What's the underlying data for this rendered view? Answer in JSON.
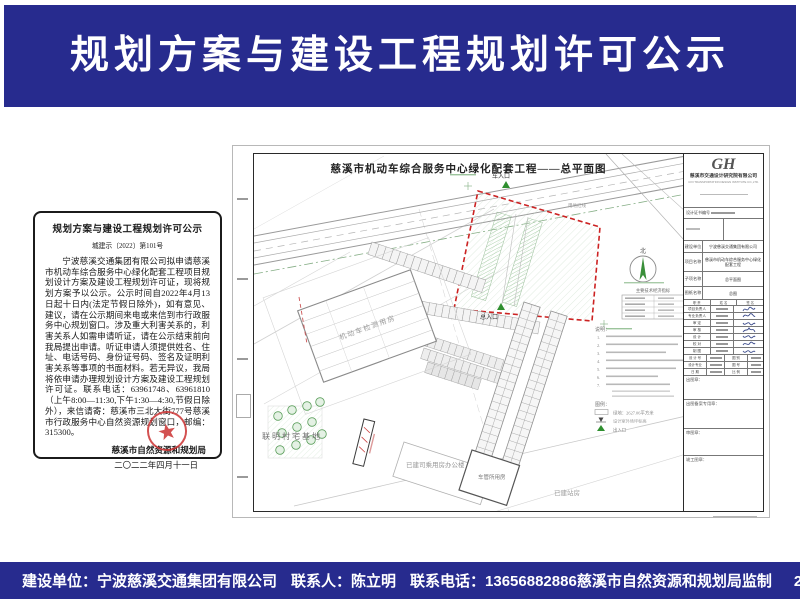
{
  "banner": {
    "title": "规划方案与建设工程规划许可公示"
  },
  "notice": {
    "title": "规划方案与建设工程规划许可公示",
    "doc_no": "城建示〔2022〕第101号",
    "body": "宁波慈溪交通集团有限公司拟申请慈溪市机动车综合服务中心绿化配套工程项目规划设计方案及建设工程规划许可证，现将规划方案予以公示。公示时间自2022年4月13日起十日内(法定节假日除外)，如有意见、建议，请在公示期间来电或来信到市行政服务中心规划窗口。涉及重大利害关系的，利害关系人如需申请听证，请在公示结束前向我局提出申请。听证申请人须提供姓名、住址、电话号码、身份证号码、签名及证明利害关系等事项的书面材料。若无异议，我局将依申请办理规划设计方案及建设工程规划许可证。联系电话：63961748、63961810（上午8:00—11:30,下午1:30—4:30,节假日除外），来信请寄：慈溪市三北大街777号慈溪市行政服务中心自然资源规划窗口，邮编：315300。",
    "agency": "慈溪市自然资源和规划局",
    "date": "二〇二二年四月十一日"
  },
  "drawing": {
    "title": "慈溪市机动车综合服务中心绿化配套工程——总平面图",
    "labels": {
      "vehicle_entrance": "车入口",
      "main_entrance": "总入口",
      "red_line": "用地红线",
      "north": "北",
      "inspection_building": "机动车检测用房",
      "village": "联明村宅基地",
      "office": "已建司乘用房办公楼",
      "vehicle_admin": "车管所用房",
      "station": "已建站房"
    },
    "indicator_table_title": "主要技术经济指标",
    "notes_label": "说明：",
    "note_numbers": [
      "1.",
      "2.",
      "3.",
      "4.",
      "5.",
      "6.",
      "7."
    ],
    "legend_label": "图例：",
    "legend": {
      "green_area": "绿地：2627.06平方米",
      "level_mark": "设计室外场坪标高",
      "entrance": "出入口"
    }
  },
  "titleblock": {
    "logo": "GH",
    "company": "慈溪市交通设计研究院有限公司",
    "company_en": "CIXI TRANSPORTATION DESIGN INSTITUTE CO.,LTD.",
    "cert_label": "设计证书编号",
    "info_rows": [
      {
        "label": "建设单位",
        "value": "宁波慈溪交通集团有限公司"
      },
      {
        "label": "项目名称",
        "value": "慈溪市机动车综合服务中心绿化配套工程"
      },
      {
        "label": "子项名称",
        "value": "总平面图"
      },
      {
        "label": "图纸名称",
        "value": "总图"
      }
    ],
    "sig_header": [
      "职 责",
      "姓 名",
      "签 名"
    ],
    "sig_roles": [
      "项目负责人",
      "专业负责人",
      "审 定",
      "审 核",
      "设 计",
      "校 对",
      "制 图"
    ],
    "meta_rows": [
      [
        "设 计 号",
        "图 别"
      ],
      [
        "设计专业",
        "图 号"
      ],
      [
        "日 期",
        "比 例"
      ]
    ],
    "stamps": [
      "出图章：",
      "出图备案专用章：",
      "审图章：",
      "竣工图章："
    ]
  },
  "footer": {
    "builder": "建设单位：宁波慈溪交通集团有限公司",
    "contact": "联系人：陈立明",
    "phone": "联系电话：13656882886",
    "supervisor": "慈溪市自然资源和规划局监制",
    "date": "2022年4月11日"
  },
  "colors": {
    "banner_bg": "#272b8e",
    "banner_text": "#ffffff",
    "red_line": "#cc2222",
    "entrance_green": "#2f8f2f",
    "seal_red": "#cc3333"
  }
}
